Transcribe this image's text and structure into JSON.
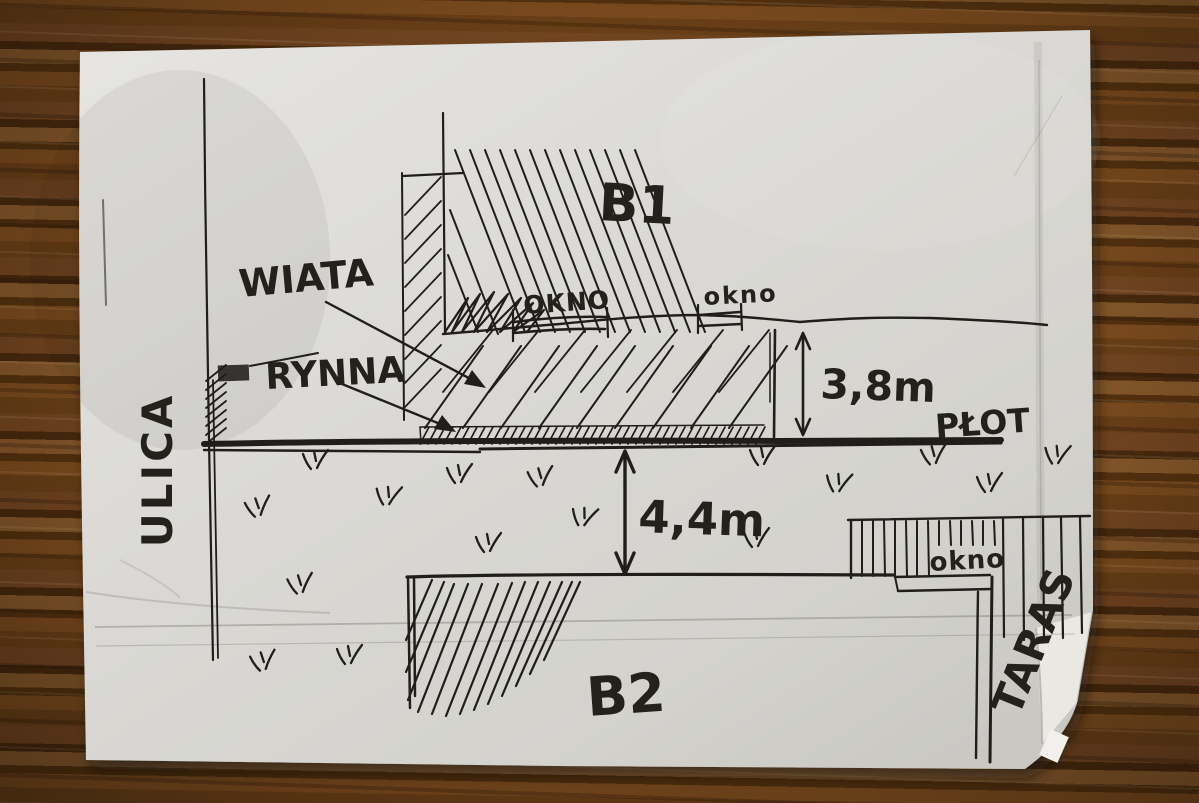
{
  "scene": {
    "kind": "hand-drawn site plan sketch on an envelope lying on a wooden table",
    "colors": {
      "ink": "#201d1a",
      "paper": "#d9d8d4",
      "paper_bright": "#e9e8e4",
      "paper_shadow": "#c0bfba",
      "wood": "#6b4017",
      "wood_dark": "#4a2a0e",
      "wood_light": "#86582a"
    }
  },
  "labels": {
    "street": "ULICA",
    "carport": "WIATA",
    "gutter": "RYNNA",
    "building_top": "B1",
    "building_bottom": "B2",
    "window_top_left": "OKNO",
    "window_top_right": "okno",
    "window_bottom": "okno",
    "fence": "PŁOT",
    "terrace": "TARAS"
  },
  "dimensions": {
    "wall_to_fence": "3,8m",
    "fence_to_b2": "4,4m"
  }
}
